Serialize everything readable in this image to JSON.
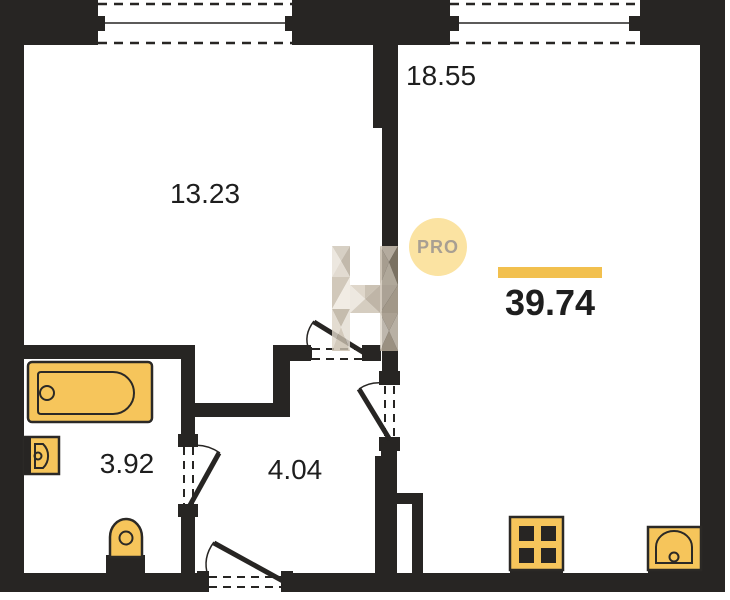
{
  "floor_plan": {
    "badge_label": "PRO",
    "total_area": "39.74",
    "rooms": [
      {
        "name": "room-top-left",
        "area": "13.23"
      },
      {
        "name": "room-top-right",
        "area": "18.55"
      },
      {
        "name": "bathroom",
        "area": "3.92"
      },
      {
        "name": "hallway",
        "area": "4.04"
      }
    ],
    "colors": {
      "wall": "#272523",
      "fixture": "#f6c55b",
      "fixture-stroke": "#2b2926",
      "accent-bar": "#f2c04e",
      "badge-fill": "#fbe3a2",
      "badge-text": "#a89f92",
      "text": "#1e1e1e"
    }
  }
}
